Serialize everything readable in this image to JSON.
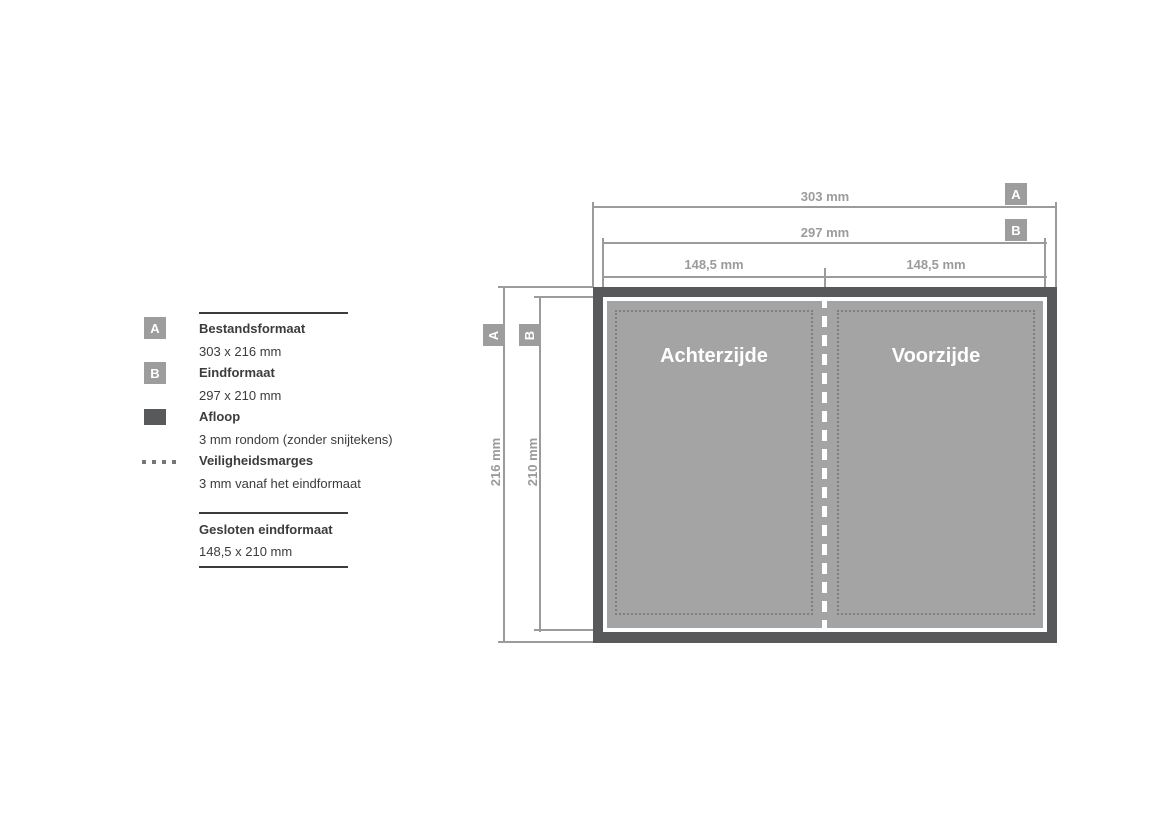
{
  "colors": {
    "bleed_dark": "#58595b",
    "panel_gray": "#a4a4a4",
    "dimension_gray": "#9b9b9b",
    "badge_gray": "#9d9d9d",
    "text_dark": "#3c3c3b",
    "dot_gray": "#767676"
  },
  "legend": {
    "items": [
      {
        "icon": "format-a-badge",
        "label": "A",
        "title": "Bestandsformaat",
        "value": "303 x 216 mm"
      },
      {
        "icon": "format-b-badge",
        "label": "B",
        "title": "Eindformaat",
        "value": "297 x 210 mm"
      },
      {
        "icon": "bleed-swatch",
        "title": "Afloop",
        "value": "3 mm rondom (zonder snijtekens)"
      },
      {
        "icon": "dotted-line",
        "title": "Veiligheidsmarges",
        "value": "3 mm vanaf het eindformaat"
      }
    ],
    "closed": {
      "title": "Gesloten eindformaat",
      "value": "148,5 x 210 mm"
    }
  },
  "diagram": {
    "dim_width_a": {
      "label": "303 mm",
      "badge": "A"
    },
    "dim_width_b": {
      "label": "297 mm",
      "badge": "B"
    },
    "dim_half_left": "148,5 mm",
    "dim_half_right": "148,5 mm",
    "dim_height_a": {
      "label": "216 mm",
      "badge": "A"
    },
    "dim_height_b": {
      "label": "210 mm",
      "badge": "B"
    },
    "panels": [
      {
        "name": "Achterzijde"
      },
      {
        "name": "Voorzijde"
      }
    ]
  }
}
